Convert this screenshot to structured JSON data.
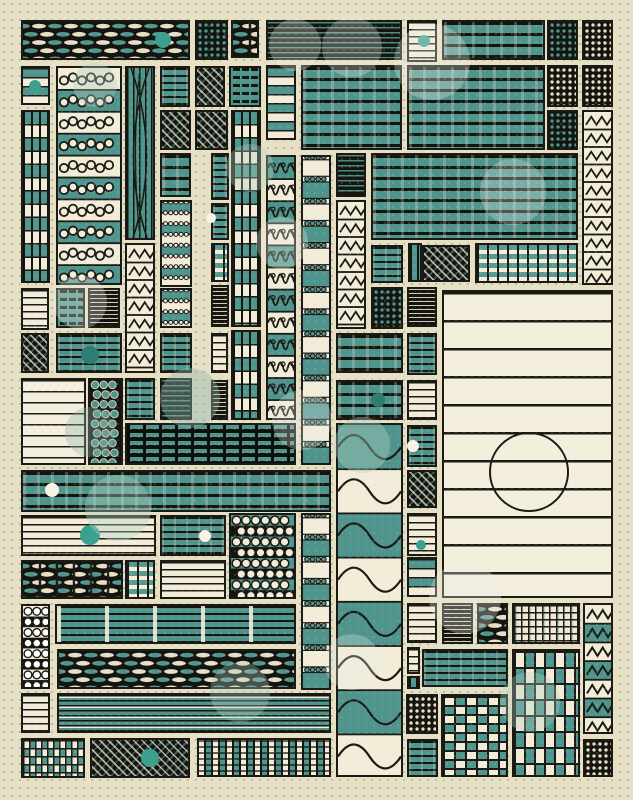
{
  "canvas": {
    "width": 633,
    "height": 800,
    "background": "#e8e0c5",
    "dot_grid_color": "#7dafa0"
  },
  "palette": {
    "teal": "#4f958d",
    "teal_deep": "#2e7d74",
    "cream": "#f2ecd8",
    "ink": "#1b1a15",
    "dark": "#15140e",
    "accent_teal": "#3ca08f",
    "accent_white": "#f8f3e4"
  },
  "tiles": [
    {
      "x": 21,
      "y": 20,
      "w": 169,
      "h": 40,
      "p": "braid"
    },
    {
      "x": 195,
      "y": 20,
      "w": 33,
      "h": 40,
      "p": "dd"
    },
    {
      "x": 231,
      "y": 20,
      "w": 28,
      "h": 38,
      "p": "basket"
    },
    {
      "x": 266,
      "y": 20,
      "w": 136,
      "h": 40,
      "p": "hfdt"
    },
    {
      "x": 407,
      "y": 20,
      "w": 30,
      "h": 42,
      "p": "hc"
    },
    {
      "x": 442,
      "y": 20,
      "w": 103,
      "h": 40,
      "p": "hts"
    },
    {
      "x": 547,
      "y": 20,
      "w": 31,
      "h": 40,
      "p": "dd"
    },
    {
      "x": 582,
      "y": 20,
      "w": 31,
      "h": 40,
      "p": "ddc"
    },
    {
      "x": 21,
      "y": 66,
      "w": 29,
      "h": 39,
      "p": "hth"
    },
    {
      "x": 56,
      "y": 66,
      "w": 66,
      "h": 219,
      "p": "loops"
    },
    {
      "x": 125,
      "y": 66,
      "w": 30,
      "h": 174,
      "p": "vcurve"
    },
    {
      "x": 160,
      "y": 66,
      "w": 30,
      "h": 41,
      "p": "ht"
    },
    {
      "x": 195,
      "y": 66,
      "w": 30,
      "h": 41,
      "p": "hd"
    },
    {
      "x": 229,
      "y": 66,
      "w": 32,
      "h": 41,
      "p": "rip"
    },
    {
      "x": 266,
      "y": 65,
      "w": 30,
      "h": 75,
      "p": "hth"
    },
    {
      "x": 301,
      "y": 65,
      "w": 101,
      "h": 85,
      "p": "hts"
    },
    {
      "x": 407,
      "y": 65,
      "w": 138,
      "h": 85,
      "p": "hts"
    },
    {
      "x": 547,
      "y": 65,
      "w": 31,
      "h": 42,
      "p": "ddc"
    },
    {
      "x": 582,
      "y": 65,
      "w": 31,
      "h": 42,
      "p": "ddc"
    },
    {
      "x": 160,
      "y": 110,
      "w": 31,
      "h": 40,
      "p": "hd"
    },
    {
      "x": 195,
      "y": 110,
      "w": 33,
      "h": 40,
      "p": "hd"
    },
    {
      "x": 231,
      "y": 110,
      "w": 30,
      "h": 217,
      "p": "vb"
    },
    {
      "x": 547,
      "y": 110,
      "w": 31,
      "h": 40,
      "p": "dd"
    },
    {
      "x": 582,
      "y": 110,
      "w": 31,
      "h": 175,
      "p": "zz"
    },
    {
      "x": 21,
      "y": 110,
      "w": 29,
      "h": 173,
      "p": "vb"
    },
    {
      "x": 160,
      "y": 153,
      "w": 31,
      "h": 44,
      "p": "hts"
    },
    {
      "x": 211,
      "y": 153,
      "w": 18,
      "h": 47,
      "p": "ht"
    },
    {
      "x": 266,
      "y": 155,
      "w": 30,
      "h": 265,
      "p": "wavc"
    },
    {
      "x": 301,
      "y": 155,
      "w": 30,
      "h": 310,
      "p": "chain"
    },
    {
      "x": 336,
      "y": 153,
      "w": 30,
      "h": 44,
      "p": "hfdt"
    },
    {
      "x": 371,
      "y": 153,
      "w": 207,
      "h": 87,
      "p": "hts"
    },
    {
      "x": 160,
      "y": 200,
      "w": 32,
      "h": 87,
      "p": "chainS"
    },
    {
      "x": 211,
      "y": 203,
      "w": 18,
      "h": 37,
      "p": "ht"
    },
    {
      "x": 336,
      "y": 200,
      "w": 30,
      "h": 129,
      "p": "zz"
    },
    {
      "x": 125,
      "y": 243,
      "w": 30,
      "h": 130,
      "p": "zz"
    },
    {
      "x": 211,
      "y": 243,
      "w": 18,
      "h": 39,
      "p": "wf"
    },
    {
      "x": 336,
      "y": 380,
      "w": 67,
      "h": 40,
      "p": "hts"
    },
    {
      "x": 371,
      "y": 245,
      "w": 32,
      "h": 38,
      "p": "ht"
    },
    {
      "x": 408,
      "y": 243,
      "w": 14,
      "h": 39,
      "p": "vt"
    },
    {
      "x": 422,
      "y": 245,
      "w": 48,
      "h": 37,
      "p": "hd"
    },
    {
      "x": 475,
      "y": 243,
      "w": 103,
      "h": 40,
      "p": "wf"
    },
    {
      "x": 21,
      "y": 288,
      "w": 28,
      "h": 42,
      "p": "hc"
    },
    {
      "x": 56,
      "y": 288,
      "w": 29,
      "h": 40,
      "p": "rip"
    },
    {
      "x": 88,
      "y": 288,
      "w": 32,
      "h": 40,
      "p": "hfd"
    },
    {
      "x": 160,
      "y": 288,
      "w": 32,
      "h": 40,
      "p": "chainS"
    },
    {
      "x": 211,
      "y": 285,
      "w": 18,
      "h": 42,
      "p": "hfd"
    },
    {
      "x": 371,
      "y": 287,
      "w": 32,
      "h": 42,
      "p": "dd"
    },
    {
      "x": 407,
      "y": 287,
      "w": 30,
      "h": 40,
      "p": "hfd"
    },
    {
      "x": 442,
      "y": 290,
      "w": 171,
      "h": 308,
      "p": "panel"
    },
    {
      "x": 21,
      "y": 333,
      "w": 28,
      "h": 40,
      "p": "hd"
    },
    {
      "x": 56,
      "y": 333,
      "w": 66,
      "h": 40,
      "p": "ht"
    },
    {
      "x": 160,
      "y": 333,
      "w": 32,
      "h": 40,
      "p": "ht"
    },
    {
      "x": 211,
      "y": 333,
      "w": 17,
      "h": 40,
      "p": "hc"
    },
    {
      "x": 231,
      "y": 330,
      "w": 30,
      "h": 90,
      "p": "vb"
    },
    {
      "x": 336,
      "y": 333,
      "w": 67,
      "h": 40,
      "p": "hts"
    },
    {
      "x": 407,
      "y": 333,
      "w": 30,
      "h": 42,
      "p": "ht"
    },
    {
      "x": 21,
      "y": 378,
      "w": 65,
      "h": 87,
      "p": "hcs"
    },
    {
      "x": 88,
      "y": 378,
      "w": 35,
      "h": 87,
      "p": "cgrid"
    },
    {
      "x": 125,
      "y": 378,
      "w": 30,
      "h": 42,
      "p": "ht"
    },
    {
      "x": 160,
      "y": 378,
      "w": 32,
      "h": 42,
      "p": "hfdt"
    },
    {
      "x": 211,
      "y": 380,
      "w": 17,
      "h": 40,
      "p": "hfd"
    },
    {
      "x": 407,
      "y": 380,
      "w": 30,
      "h": 40,
      "p": "hc"
    },
    {
      "x": 125,
      "y": 423,
      "w": 171,
      "h": 42,
      "p": "wfd"
    },
    {
      "x": 336,
      "y": 423,
      "w": 67,
      "h": 354,
      "p": "bigwave"
    },
    {
      "x": 407,
      "y": 425,
      "w": 30,
      "h": 42,
      "p": "ht"
    },
    {
      "x": 21,
      "y": 470,
      "w": 310,
      "h": 42,
      "p": "hts"
    },
    {
      "x": 407,
      "y": 470,
      "w": 30,
      "h": 38,
      "p": "hd"
    },
    {
      "x": 21,
      "y": 515,
      "w": 135,
      "h": 41,
      "p": "hc"
    },
    {
      "x": 160,
      "y": 515,
      "w": 66,
      "h": 41,
      "p": "ht"
    },
    {
      "x": 229,
      "y": 513,
      "w": 67,
      "h": 86,
      "p": "pearls"
    },
    {
      "x": 301,
      "y": 513,
      "w": 30,
      "h": 177,
      "p": "chain"
    },
    {
      "x": 407,
      "y": 513,
      "w": 30,
      "h": 43,
      "p": "hc"
    },
    {
      "x": 21,
      "y": 560,
      "w": 102,
      "h": 39,
      "p": "basket"
    },
    {
      "x": 125,
      "y": 560,
      "w": 30,
      "h": 39,
      "p": "wf"
    },
    {
      "x": 160,
      "y": 560,
      "w": 66,
      "h": 39,
      "p": "hc"
    },
    {
      "x": 407,
      "y": 557,
      "w": 30,
      "h": 40,
      "p": "hth"
    },
    {
      "x": 21,
      "y": 604,
      "w": 29,
      "h": 85,
      "p": "pearlsc"
    },
    {
      "x": 55,
      "y": 604,
      "w": 241,
      "h": 40,
      "p": "st"
    },
    {
      "x": 407,
      "y": 603,
      "w": 30,
      "h": 40,
      "p": "hc"
    },
    {
      "x": 442,
      "y": 603,
      "w": 31,
      "h": 41,
      "p": "hfd"
    },
    {
      "x": 477,
      "y": 603,
      "w": 31,
      "h": 41,
      "p": "braid"
    },
    {
      "x": 512,
      "y": 603,
      "w": 68,
      "h": 41,
      "p": "xhc"
    },
    {
      "x": 583,
      "y": 603,
      "w": 30,
      "h": 131,
      "p": "zzb"
    },
    {
      "x": 57,
      "y": 649,
      "w": 239,
      "h": 40,
      "p": "braid"
    },
    {
      "x": 407,
      "y": 647,
      "w": 13,
      "h": 27,
      "p": "hc"
    },
    {
      "x": 422,
      "y": 649,
      "w": 86,
      "h": 38,
      "p": "ht"
    },
    {
      "x": 512,
      "y": 649,
      "w": 68,
      "h": 128,
      "p": "ckt"
    },
    {
      "x": 407,
      "y": 676,
      "w": 13,
      "h": 13,
      "p": "vt"
    },
    {
      "x": 21,
      "y": 693,
      "w": 29,
      "h": 40,
      "p": "hc"
    },
    {
      "x": 57,
      "y": 693,
      "w": 274,
      "h": 40,
      "p": "fine"
    },
    {
      "x": 406,
      "y": 694,
      "w": 32,
      "h": 40,
      "p": "ddc"
    },
    {
      "x": 441,
      "y": 694,
      "w": 67,
      "h": 83,
      "p": "ck"
    },
    {
      "x": 21,
      "y": 738,
      "w": 64,
      "h": 40,
      "p": "cks"
    },
    {
      "x": 90,
      "y": 738,
      "w": 100,
      "h": 40,
      "p": "hd"
    },
    {
      "x": 197,
      "y": 738,
      "w": 134,
      "h": 39,
      "p": "vbd"
    },
    {
      "x": 407,
      "y": 739,
      "w": 31,
      "h": 38,
      "p": "ht"
    },
    {
      "x": 583,
      "y": 739,
      "w": 30,
      "h": 38,
      "p": "ddc"
    }
  ],
  "accents": [
    {
      "cx": 163,
      "cy": 40,
      "r": 8,
      "fill": "#3ca08f"
    },
    {
      "cx": 35,
      "cy": 86,
      "r": 6,
      "fill": "#3ca08f"
    },
    {
      "cx": 424,
      "cy": 41,
      "r": 6,
      "fill": "#3ca08f"
    },
    {
      "cx": 90,
      "cy": 355,
      "r": 9,
      "fill": "#2e7d74"
    },
    {
      "cx": 378,
      "cy": 400,
      "r": 7,
      "fill": "#2e7d74"
    },
    {
      "cx": 52,
      "cy": 490,
      "r": 7,
      "fill": "#f8f3e4"
    },
    {
      "cx": 90,
      "cy": 535,
      "r": 10,
      "fill": "#3ca08f"
    },
    {
      "cx": 205,
      "cy": 536,
      "r": 6,
      "fill": "#f8f3e4"
    },
    {
      "cx": 413,
      "cy": 446,
      "r": 6,
      "fill": "#f8f3e4"
    },
    {
      "cx": 421,
      "cy": 545,
      "r": 5,
      "fill": "#3ca08f"
    },
    {
      "cx": 150,
      "cy": 758,
      "r": 9,
      "fill": "#3ca08f"
    },
    {
      "cx": 211,
      "cy": 218,
      "r": 5,
      "fill": "#f8f3e4"
    },
    {
      "cx": 527,
      "cy": 470,
      "r": 38,
      "fill": "none",
      "stroke": "#1b1a15"
    }
  ],
  "bokeh": [
    {
      "cx": 295,
      "cy": 45,
      "r": 26,
      "color": "rgba(237,242,232,0.30)"
    },
    {
      "cx": 352,
      "cy": 47,
      "r": 30,
      "color": "rgba(237,242,232,0.28)"
    },
    {
      "cx": 432,
      "cy": 62,
      "r": 38,
      "color": "rgba(237,242,232,0.30)"
    },
    {
      "cx": 513,
      "cy": 192,
      "r": 33,
      "color": "rgba(237,242,232,0.28)"
    },
    {
      "cx": 95,
      "cy": 85,
      "r": 22,
      "color": "rgba(180,210,195,0.35)"
    },
    {
      "cx": 250,
      "cy": 168,
      "r": 24,
      "color": "rgba(180,210,195,0.35)"
    },
    {
      "cx": 282,
      "cy": 243,
      "r": 26,
      "color": "rgba(237,242,232,0.30)"
    },
    {
      "cx": 80,
      "cy": 302,
      "r": 27,
      "color": "rgba(237,242,232,0.30)"
    },
    {
      "cx": 190,
      "cy": 398,
      "r": 30,
      "color": "rgba(144,180,170,0.40)"
    },
    {
      "cx": 90,
      "cy": 432,
      "r": 25,
      "color": "rgba(144,180,170,0.35)"
    },
    {
      "cx": 302,
      "cy": 420,
      "r": 30,
      "color": "rgba(237,242,232,0.28)"
    },
    {
      "cx": 118,
      "cy": 508,
      "r": 33,
      "color": "rgba(180,210,195,0.38)"
    },
    {
      "cx": 362,
      "cy": 445,
      "r": 28,
      "color": "rgba(180,210,195,0.38)"
    },
    {
      "cx": 465,
      "cy": 598,
      "r": 36,
      "color": "rgba(237,242,232,0.30)"
    },
    {
      "cx": 240,
      "cy": 692,
      "r": 30,
      "color": "rgba(180,210,195,0.33)"
    },
    {
      "cx": 352,
      "cy": 662,
      "r": 28,
      "color": "rgba(237,242,232,0.28)"
    },
    {
      "cx": 530,
      "cy": 702,
      "r": 30,
      "color": "rgba(180,210,195,0.33)"
    }
  ]
}
